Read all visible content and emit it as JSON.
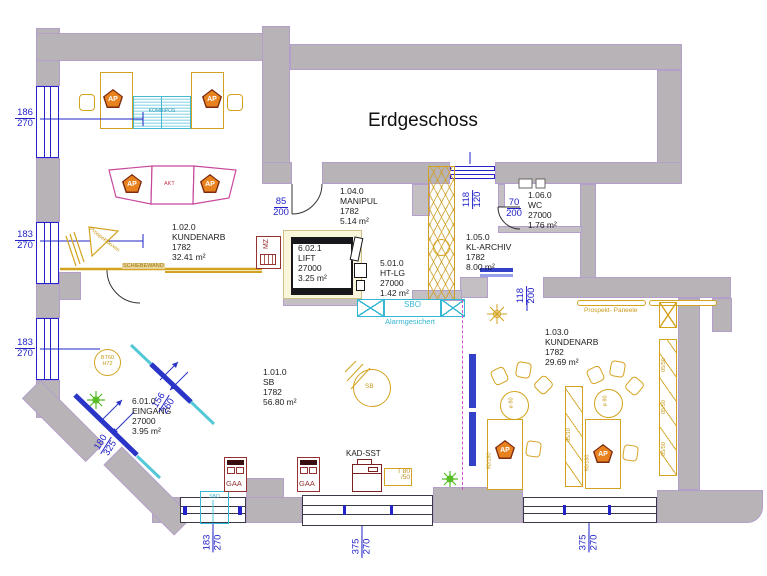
{
  "title": "Erdgeschoss",
  "rooms": [
    {
      "id": "1.02.0",
      "name": "KUNDENARB",
      "code": "1782",
      "area": "32.41 m²"
    },
    {
      "id": "1.04.0",
      "name": "MANIPUL",
      "code": "1782",
      "area": "5.14 m²"
    },
    {
      "id": "6.02.1",
      "name": "LIFT",
      "code": "27000",
      "area": "3.25 m²"
    },
    {
      "id": "5.01.0",
      "name": "HT-LG",
      "code": "27000",
      "area": "1.42 m²"
    },
    {
      "id": "1.06.0",
      "name": "WC",
      "code": "27000",
      "area": "1.76 m²"
    },
    {
      "id": "1.05.0",
      "name": "KL-ARCHIV",
      "code": "1782",
      "area": "8.00 m²"
    },
    {
      "id": "1.03.0",
      "name": "KUNDENARB",
      "code": "1782",
      "area": "29.69 m²"
    },
    {
      "id": "1.01.0",
      "name": "SB",
      "code": "1782",
      "area": "56.80 m²"
    },
    {
      "id": "6.01.0",
      "name": "EINGANG",
      "code": "27000",
      "area": "3.95 m²"
    }
  ],
  "dimensions": {
    "w186": {
      "num": "186",
      "den": "270"
    },
    "w183": {
      "num": "183",
      "den": "270"
    },
    "w375": {
      "num": "375",
      "den": "270"
    },
    "d85": {
      "num": "85",
      "den": "200"
    },
    "d70": {
      "num": "70",
      "den": "200"
    },
    "d118_120": {
      "num": "118",
      "den": "120"
    },
    "d118_200": {
      "num": "118",
      "den": "200"
    },
    "d156": {
      "num": "156",
      "den": "260"
    },
    "d180": {
      "num": "180",
      "den": "325"
    }
  },
  "labels": {
    "ap": "AP",
    "gaa": "GAA",
    "mz": "MZ",
    "akt": "AKT",
    "sb": "SB",
    "sbo": "SBO",
    "alarm": "Alarmgesichert",
    "kad_sst": "KAD-SST",
    "t80": "T 80",
    "t50": "/50",
    "bt60": "BT60",
    "h72": "H72",
    "prospekt_paneele": "Prospekt- Paneele",
    "prospektboxen": "Prospektboxen",
    "diameter": "ø 80",
    "schiebewand": "SCHIEBEWAND",
    "kombipos": "KOMBIPOS",
    "sbop": "SBO",
    "desk_dim": "90/180",
    "shelf_dim_mid": "05/10",
    "shelf_dim_right": "05/50"
  },
  "colors": {
    "wall": "#b7b3b7",
    "dim_blue": "#2323c8",
    "furniture_gold": "#d3a21e",
    "counter_magenta": "#c8489c",
    "cyan": "#35b6d2",
    "alarm_red": "#953131",
    "ap_orange": "#e8821f",
    "plant_green": "#55bb22"
  }
}
